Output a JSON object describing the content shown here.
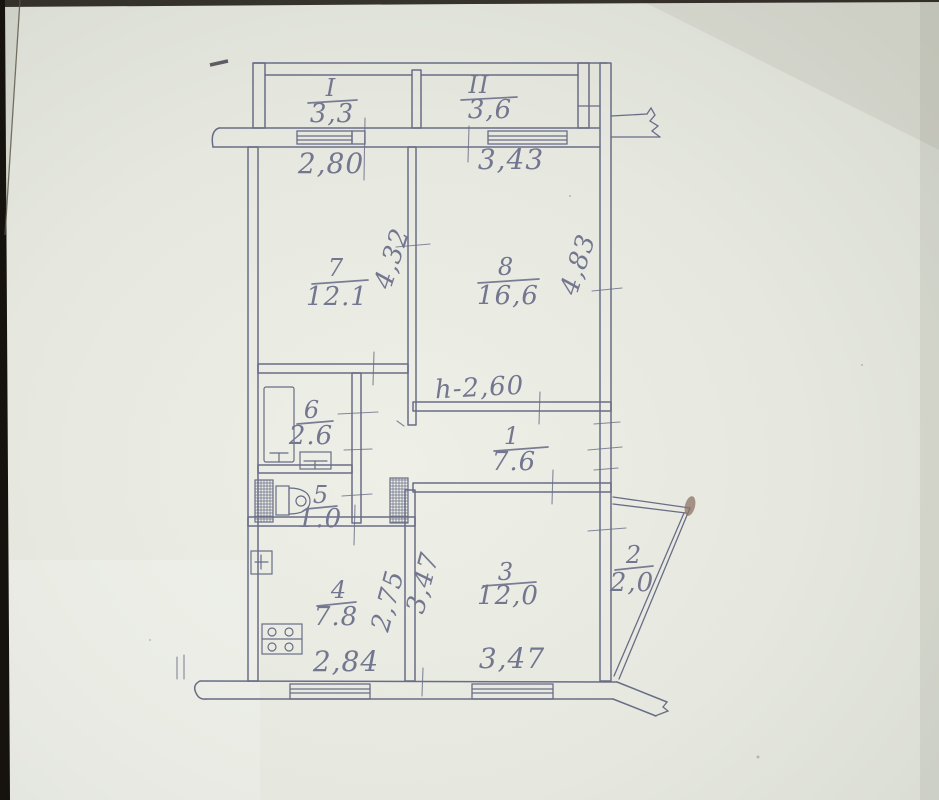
{
  "colors": {
    "paper": "#e6e8e0",
    "line": "#686d86",
    "text": "#73768f",
    "edge": "#16120e",
    "smudge": "#8d7366"
  },
  "labels": {
    "balcony_i": {
      "num": "I",
      "area": "3,3"
    },
    "balcony_ii": {
      "num": "II",
      "area": "3,6"
    },
    "room7": {
      "num": "7",
      "area": "12.1"
    },
    "room8": {
      "num": "8",
      "area": "16,6"
    },
    "room6": {
      "num": "6",
      "area": "2.6"
    },
    "room5": {
      "num": "5",
      "area": "1.0"
    },
    "room4": {
      "num": "4",
      "area": "7.8"
    },
    "room3": {
      "num": "3",
      "area": "12,0"
    },
    "room2": {
      "num": "2",
      "area": "2,0"
    },
    "room1": {
      "num": "1",
      "area": "7.6"
    }
  },
  "dimensions": {
    "top_left": "2,80",
    "top_right": "3,43",
    "room7_depth": "4,32",
    "room8_depth": "4,83",
    "height_note": "h-2,60",
    "kitchen_depth": "2,75",
    "room3_depth": "3,47",
    "bottom_left": "2,84",
    "bottom_right": "3,47"
  }
}
